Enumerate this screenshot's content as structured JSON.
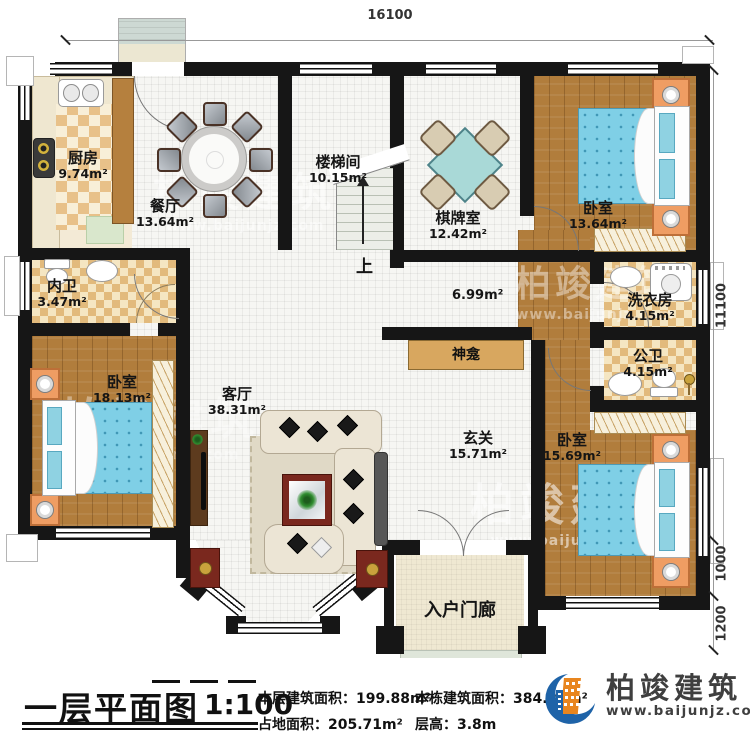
{
  "dimensions": {
    "width": "16100",
    "height": "11100",
    "seg_1000": "1000",
    "seg_1200": "1200"
  },
  "rooms": [
    {
      "name": "厨房",
      "area": "9.74m²"
    },
    {
      "name": "餐厅",
      "area": "13.64m²"
    },
    {
      "name": "楼梯间",
      "area": "10.15m²"
    },
    {
      "name": "棋牌室",
      "area": "12.42m²"
    },
    {
      "name": "卧室",
      "area": "13.64m²"
    },
    {
      "name": "内卫",
      "area": "3.47m²"
    },
    {
      "name": "洗衣房",
      "area": "4.15m²"
    },
    {
      "name": "公卫",
      "area": "4.15m²"
    },
    {
      "name": "卧室",
      "area": "18.13m²"
    },
    {
      "name": "客厅",
      "area": "38.31m²"
    },
    {
      "name": "玄关",
      "area": "15.71m²"
    },
    {
      "name": "卧室",
      "area": "15.69m²"
    }
  ],
  "annotations": {
    "corridor_area": "6.99m²",
    "shrine": "神龛",
    "up": "上",
    "porch": "入户门廊"
  },
  "title_block": {
    "title": "一层平面图",
    "scale": "1:100",
    "stats": [
      {
        "label": "本层建筑面积：",
        "value": "199.88m²"
      },
      {
        "label": "占地面积：",
        "value": "205.71m²"
      },
      {
        "label": "本栋建筑面积：",
        "value": "384.28m²"
      },
      {
        "label": "层高：",
        "value": "3.8m"
      }
    ]
  },
  "logo": {
    "name": "柏竣建筑",
    "url": "www.baijunjz.com"
  },
  "watermark": {
    "name": "柏竣建筑",
    "url": "www.baijunjz.com"
  },
  "colors": {
    "wall": "#161616",
    "wood": "#b17d3c",
    "bed_blue": "#7fcfe6",
    "accent_orange": "#ef9d63",
    "logo_blue": "#1e63a8",
    "logo_orange": "#e8851e"
  }
}
